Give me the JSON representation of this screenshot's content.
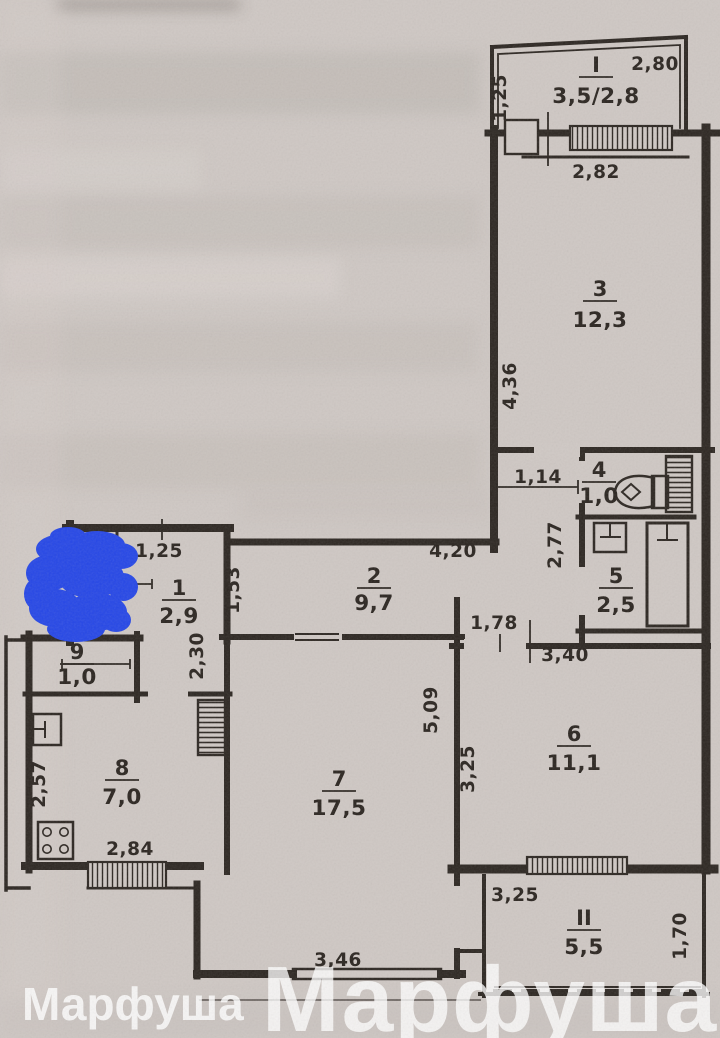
{
  "document_type": "scanned apartment floor plan",
  "colors": {
    "paper": "#cfc8c4",
    "ink": "#2d2722",
    "scribble": "#2647e6",
    "watermark": "#ffffff"
  },
  "watermarks": {
    "small": "Марфуша",
    "large": "Марфуша"
  },
  "rooms": [
    {
      "num": "I",
      "area": "3,5/2,8",
      "cx": 596,
      "ny": 72,
      "ay": 103
    },
    {
      "num": "3",
      "area": "12,3",
      "cx": 600,
      "ny": 296,
      "ay": 327
    },
    {
      "num": "4",
      "area": "1,0",
      "cx": 599,
      "ny": 477,
      "ay": 503
    },
    {
      "num": "5",
      "area": "2,5",
      "cx": 616,
      "ny": 583,
      "ay": 612
    },
    {
      "num": "2",
      "area": "9,7",
      "cx": 374,
      "ny": 583,
      "ay": 610
    },
    {
      "num": "1",
      "area": "2,9",
      "cx": 179,
      "ny": 595,
      "ay": 623
    },
    {
      "num": "9",
      "area": "1,0",
      "cx": 77,
      "ny": 659,
      "ay": 684
    },
    {
      "num": "8",
      "area": "7,0",
      "cx": 122,
      "ny": 775,
      "ay": 804
    },
    {
      "num": "7",
      "area": "17,5",
      "cx": 339,
      "ny": 786,
      "ay": 815
    },
    {
      "num": "6",
      "area": "11,1",
      "cx": 574,
      "ny": 741,
      "ay": 770
    },
    {
      "num": "II",
      "area": "5,5",
      "cx": 584,
      "ny": 925,
      "ay": 954
    }
  ],
  "dimensions": [
    {
      "text": "2,80",
      "x": 655,
      "y": 70,
      "rot": 0
    },
    {
      "text": "1,25",
      "x": 506,
      "y": 98,
      "rot": -90
    },
    {
      "text": "2,82",
      "x": 596,
      "y": 178,
      "rot": 0
    },
    {
      "text": "4,36",
      "x": 516,
      "y": 386,
      "rot": -90
    },
    {
      "text": "1,14",
      "x": 538,
      "y": 483,
      "rot": 0
    },
    {
      "text": "2,77",
      "x": 561,
      "y": 545,
      "rot": -90
    },
    {
      "text": "4,20",
      "x": 453,
      "y": 557,
      "rot": 0
    },
    {
      "text": "1,25",
      "x": 159,
      "y": 557,
      "rot": 0
    },
    {
      "text": "1,53",
      "x": 239,
      "y": 590,
      "rot": -90
    },
    {
      "text": "2,30",
      "x": 203,
      "y": 656,
      "rot": -90
    },
    {
      "text": "1,78",
      "x": 494,
      "y": 629,
      "rot": 0
    },
    {
      "text": "3,40",
      "x": 565,
      "y": 661,
      "rot": 0
    },
    {
      "text": "5,09",
      "x": 437,
      "y": 710,
      "rot": -90
    },
    {
      "text": "3,25",
      "x": 474,
      "y": 769,
      "rot": -90
    },
    {
      "text": "2,57",
      "x": 45,
      "y": 784,
      "rot": -90
    },
    {
      "text": "2,84",
      "x": 130,
      "y": 855,
      "rot": 0
    },
    {
      "text": "3,46",
      "x": 338,
      "y": 966,
      "rot": 0
    },
    {
      "text": "3,25",
      "x": 515,
      "y": 901,
      "rot": 0
    },
    {
      "text": "1,70",
      "x": 686,
      "y": 936,
      "rot": -90
    }
  ],
  "fixtures": [
    "toilet",
    "wash-basin",
    "bathtub",
    "kitchen-sink",
    "stove-4-burner",
    "ventilation-shaft-bathroom",
    "ventilation-shaft-kitchen"
  ]
}
